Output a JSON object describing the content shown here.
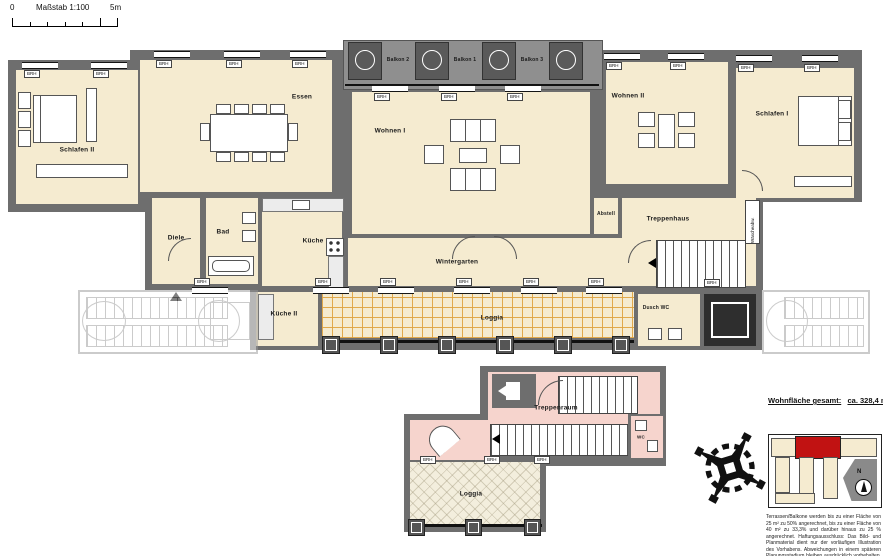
{
  "scalebar": {
    "zero": "0",
    "label": "Maßstab 1:100",
    "end": "5m"
  },
  "rooms": {
    "schlafen2": "Schlafen II",
    "essen": "Essen",
    "wohnen1": "Wohnen I",
    "wohnen2": "Wohnen II",
    "schlafen1": "Schlafen I",
    "diele": "Diele",
    "bad": "Bad",
    "kueche": "Küche",
    "wintergarten": "Wintergarten",
    "abstell": "Abstell",
    "treppenhaus": "Treppenhaus",
    "kueche2": "Küche II",
    "loggia": "Loggia",
    "duschwc": "Dusch WC"
  },
  "balconies": {
    "b2": "Balkon 2",
    "b1": "Balkon 1",
    "b3": "Balkon 3"
  },
  "window_label": "BRH",
  "chute_label": "Wäscheabw.",
  "lower": {
    "treppenraum": "Treppenraum",
    "wc": "WC",
    "loggia": "Loggia"
  },
  "summary": {
    "label": "Wohnfläche gesamt:",
    "value": "ca. 328,4 m²"
  },
  "sitekey": {
    "north": "N"
  },
  "disclaimer": "Terrassen/Balkone werden bis zu einer Fläche von 25 m² zu 50% angerechnet, bis zu einer Fläche von 40 m² zu 33,3% und darüber hinaus zu 25 % angerechnet. Haftungsausschluss: Das Bild- und Planmaterial dient nur der vorläufigen Illustration des Vorhabens. Abweichungen in einem späteren Planungsstadium bleiben ausdrücklich vorbehalten. Stand: 21. März 2013",
  "colors": {
    "wall": "#6e6e6e",
    "room_fill": "#f5ebd0",
    "stair_pink": "#f6d4cd",
    "loggia_tile": "#dfa23e",
    "highlight_red": "#c11212",
    "balcony_gray": "#8f8f8f"
  }
}
